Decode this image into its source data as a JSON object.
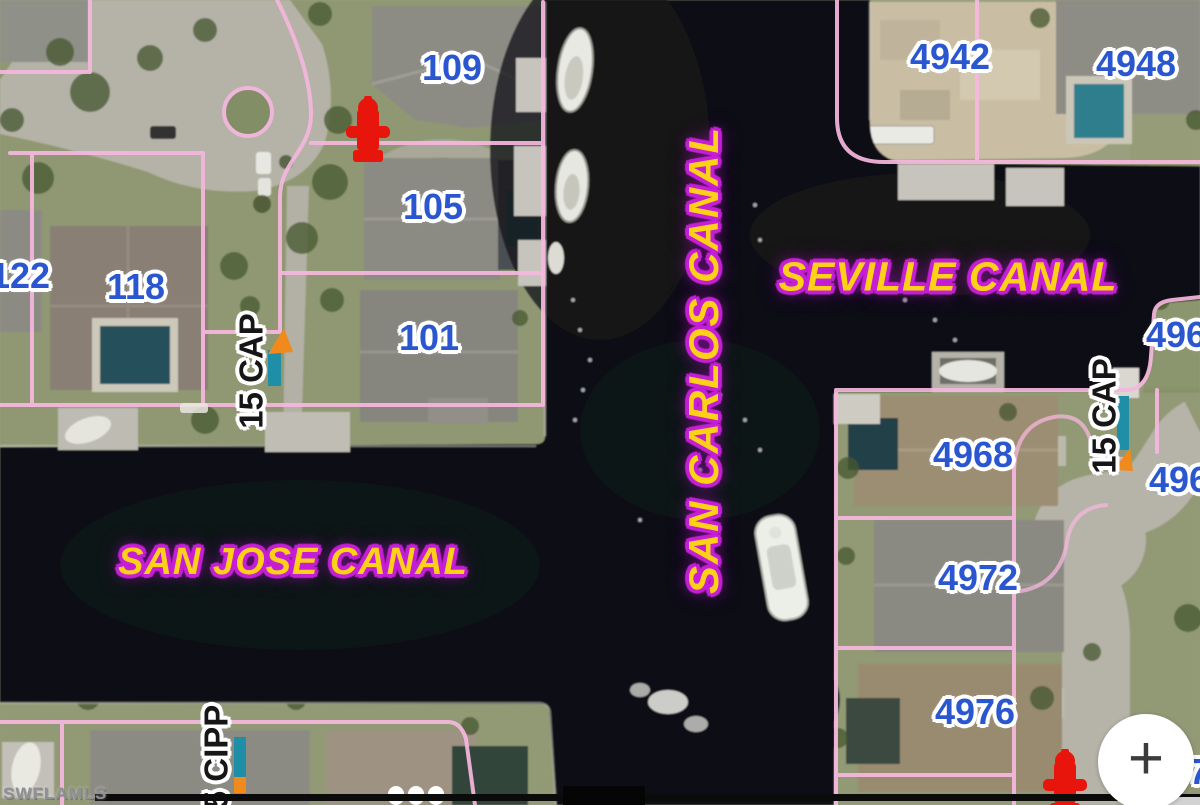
{
  "map": {
    "watermark": "SWFLAMLS",
    "controls": {
      "zoom_in": "+"
    },
    "canals": [
      {
        "name": "SAN CARLOS CANAL",
        "orientation": "vertical"
      },
      {
        "name": "SEVILLE CANAL",
        "orientation": "horizontal"
      },
      {
        "name": "SAN JOSE CANAL",
        "orientation": "horizontal"
      }
    ],
    "lots": [
      {
        "number": "109"
      },
      {
        "number": "105"
      },
      {
        "number": "101"
      },
      {
        "number": "118"
      },
      {
        "number": "122"
      },
      {
        "number": "4942"
      },
      {
        "number": "4948"
      },
      {
        "number": "4960"
      },
      {
        "number": "4964"
      },
      {
        "number": "4968"
      },
      {
        "number": "4972"
      },
      {
        "number": "4976"
      },
      {
        "number": "7"
      }
    ],
    "utility_markers": [
      {
        "label": "15 CAP"
      },
      {
        "label": "15 CAP"
      },
      {
        "label": "5 CIPP"
      }
    ],
    "colors": {
      "water": "#0d0e12",
      "parcel_line": "#f6b7de",
      "lot_number": "#2a56cf",
      "canal_fill": "#ffd018",
      "canal_outline": "#c51fd6",
      "marker_teal": "#1f8fa8",
      "marker_orange": "#f08a1d",
      "hydrant_red": "#e8150c"
    }
  }
}
